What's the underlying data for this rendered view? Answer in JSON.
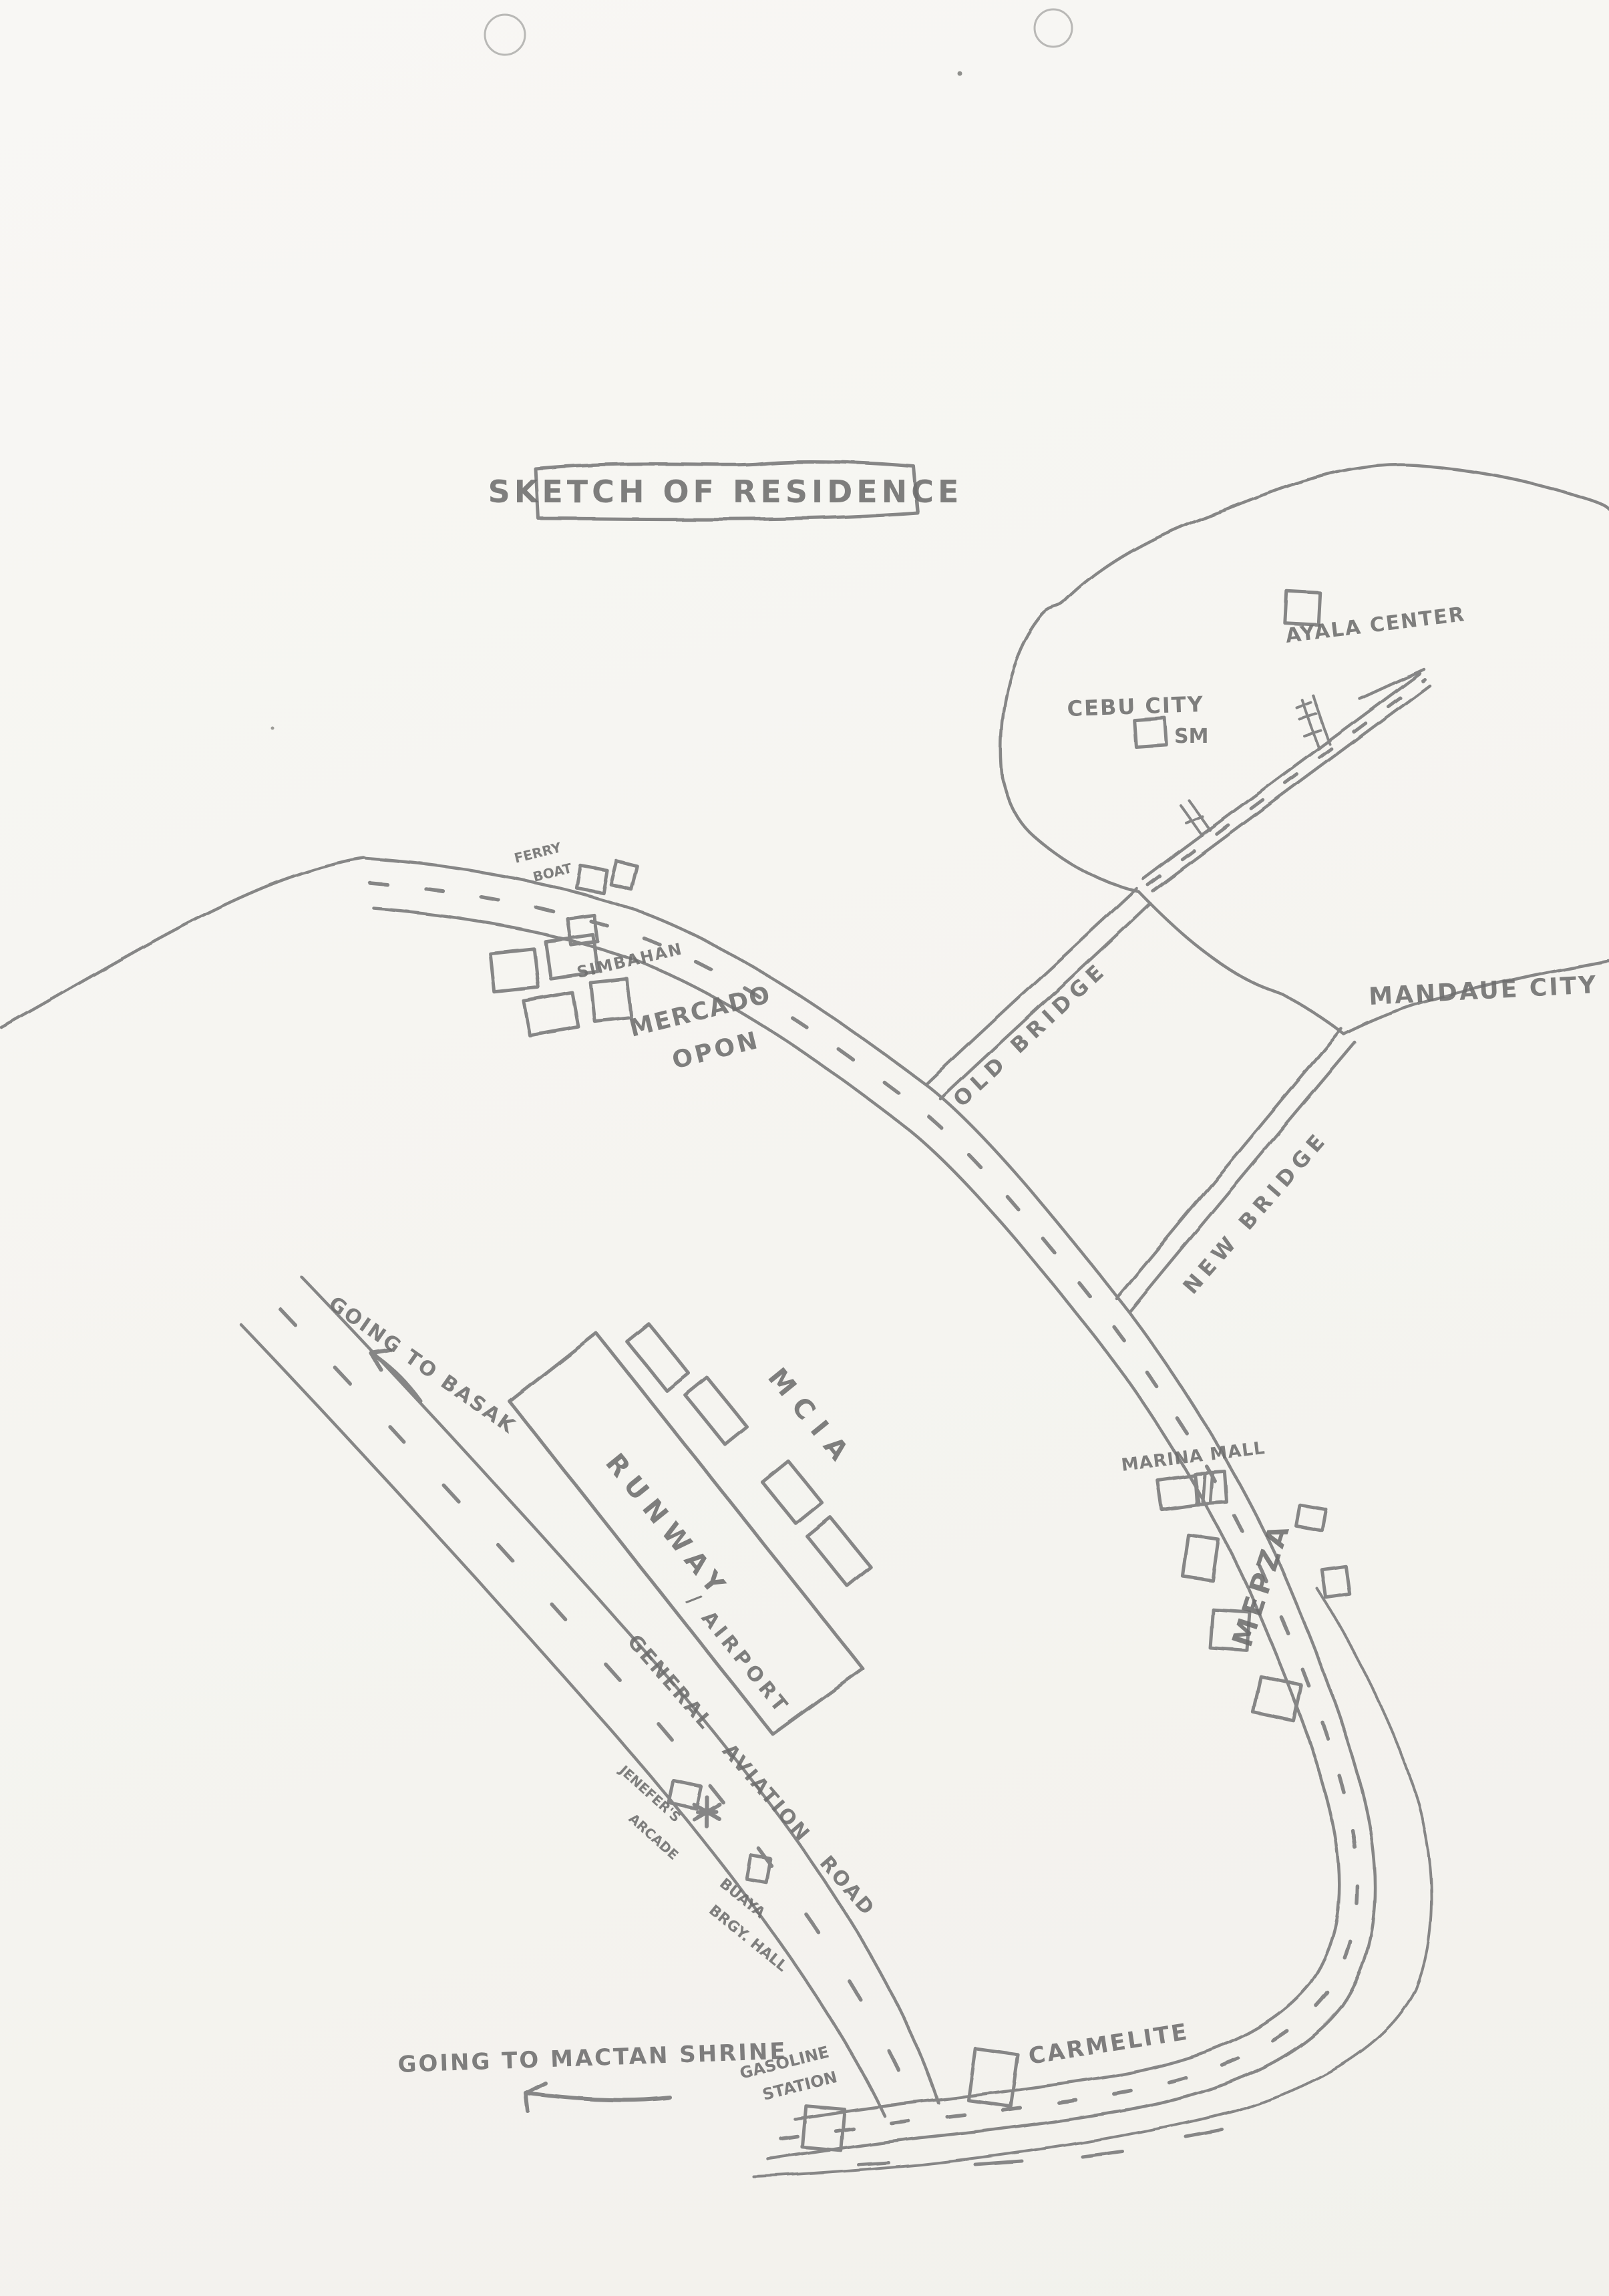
{
  "style": {
    "pencil_color": "#868686",
    "text_color": "#6e6e6e",
    "paper_color": "#f6f5f2"
  },
  "title": "SKETCH OF RESIDENCE",
  "mainland": {
    "cebu_city": "CEBU CITY",
    "sm": "SM",
    "ayala_center": "AYALA CENTER",
    "mandaue_city": "MANDAUE CITY"
  },
  "bridges": {
    "old_bridge": "OLD BRIDGE",
    "new_bridge": "NEW BRIDGE"
  },
  "north_area": {
    "ferry_line1": "FERRY",
    "ferry_line2": "BOAT",
    "simbahan": "SIMBAHAN",
    "mercado_line1": "MERCADO",
    "mercado_line2": "OPON"
  },
  "airport_area": {
    "mcia": "MCIA",
    "runway": "RUNWAY",
    "airport": "/ AIRPORT"
  },
  "east_area": {
    "marina_mall": "MARINA MALL",
    "mepza": "MEPZA"
  },
  "roads": {
    "general_aviation_road": "GENERAL AVIATION ROAD",
    "going_to_basak": "GOING TO BASAK",
    "going_to_mactan_shrine": "GOING TO MACTAN SHRINE"
  },
  "south_area": {
    "jenefers_line1": "JENEFER'S",
    "jenefers_line2": "ARCADE",
    "buaya_line1": "BUAYA",
    "buaya_line2": "BRGY. HALL",
    "gasoline_line1": "GASOLINE",
    "gasoline_line2": "STATION",
    "carmelite": "CARMELITE"
  }
}
